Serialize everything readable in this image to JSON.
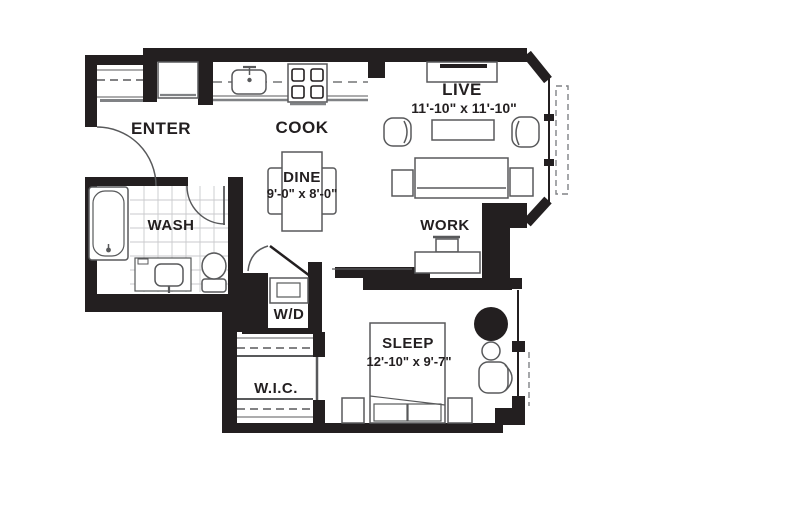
{
  "floorplan": {
    "colors": {
      "wall": "#231f20",
      "furniture_line": "#58595b",
      "light_line": "#808285",
      "tile_line": "#c9cacc",
      "text": "#231f20",
      "background": "#ffffff"
    },
    "rooms": {
      "enter": {
        "label": "ENTER"
      },
      "cook": {
        "label": "COOK"
      },
      "live": {
        "label": "LIVE",
        "dims": "11'-10\" x 11'-10\""
      },
      "dine": {
        "label": "DINE",
        "dims": "9'-0\" x 8'-0\""
      },
      "wash": {
        "label": "WASH"
      },
      "work": {
        "label": "WORK"
      },
      "wd": {
        "label": "W/D"
      },
      "sleep": {
        "label": "SLEEP",
        "dims": "12'-10\" x 9'-7\""
      },
      "wic": {
        "label": "W.I.C."
      }
    }
  }
}
